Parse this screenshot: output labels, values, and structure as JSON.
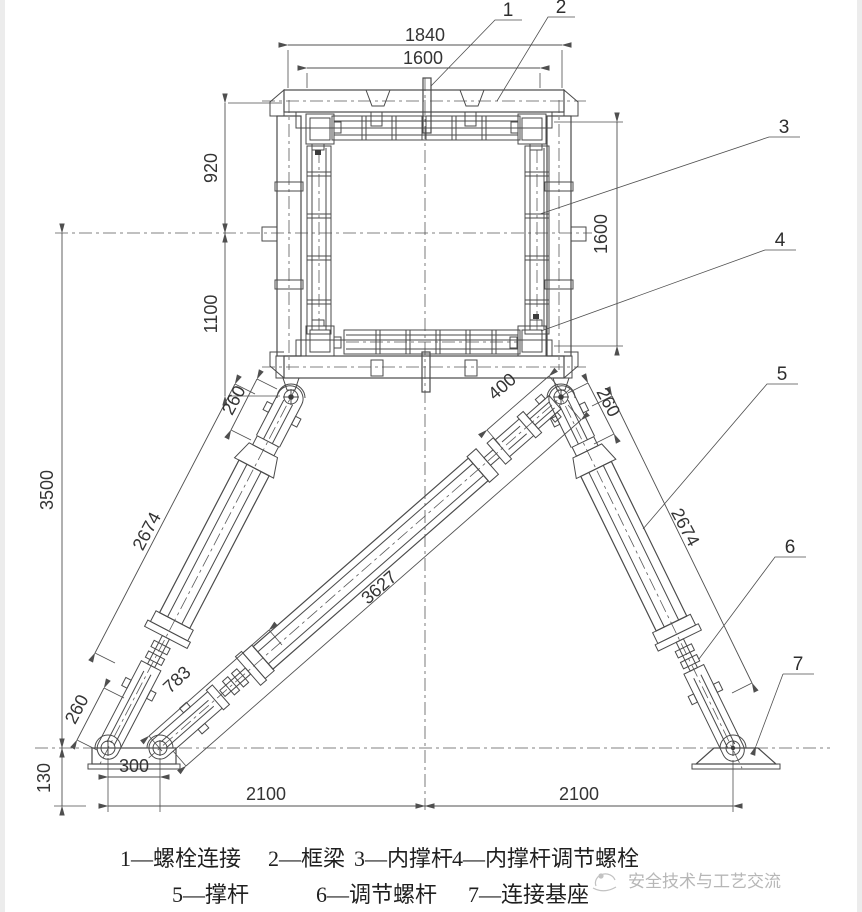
{
  "drawing": {
    "dims": {
      "top_outer": "1840",
      "top_inner": "1600",
      "left_upper": "920",
      "left_lower": "1100",
      "right_side": "1600",
      "overall_height": "3500",
      "leg_left": "2674",
      "leg_right": "2674",
      "diag_strut": "3627",
      "lower_link": "783",
      "clevis_top_left": "260",
      "clevis_top_right": "260",
      "clevis_bottom_left": "260",
      "adjuster_top": "400",
      "base_pin_spacing": "300",
      "base_height": "130",
      "span_left": "2100",
      "span_right": "2100"
    },
    "callouts": {
      "c1": "1",
      "c2": "2",
      "c3": "3",
      "c4": "4",
      "c5": "5",
      "c6": "6",
      "c7": "7"
    },
    "legend": {
      "row1": [
        "1—螺栓连接",
        "2—框梁",
        "3—内撑杆",
        "4—内撑杆调节螺栓"
      ],
      "row2": [
        "5—撑杆",
        "6—调节螺杆",
        "7—连接基座"
      ]
    },
    "watermark": "安全技术与工艺交流",
    "colors": {
      "line": "#4a4a4a",
      "dimension": "#4f4f4f",
      "text": "#343434",
      "watermark": "#b7b7b7",
      "background": "#ffffff"
    }
  }
}
